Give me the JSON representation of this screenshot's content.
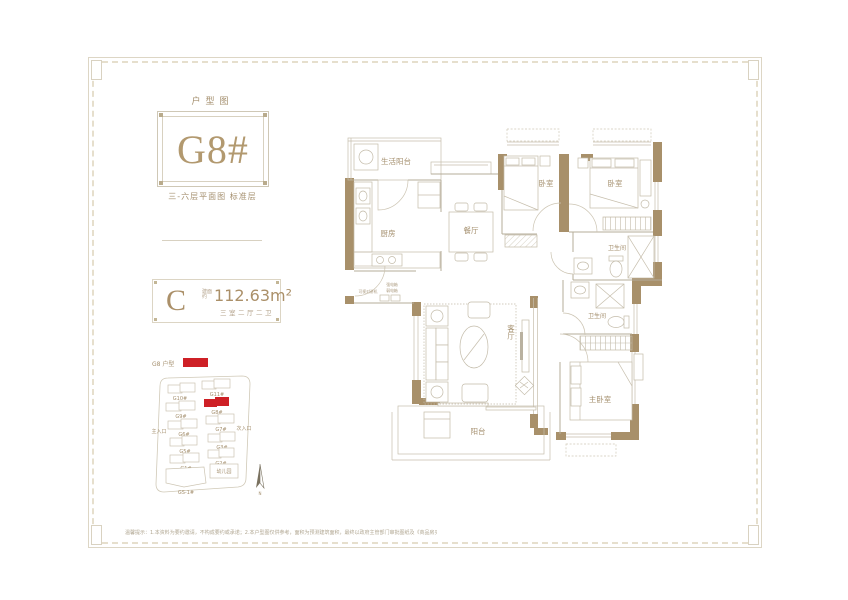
{
  "colors": {
    "accent_bronze": "#ab9069",
    "wall_tan": "#a8906a",
    "highlight_red": "#ce2026",
    "line_light": "#c6beac",
    "background": "#ffffff"
  },
  "header": {
    "title": "户型图",
    "unit_code": "G8#",
    "floor_note": "三-六层平面图 标准层"
  },
  "badge": {
    "type_letter": "C",
    "area_prefix": "建面约",
    "area_value": "112.63m²",
    "rooms_desc": "三室二厅二卫"
  },
  "site_plan": {
    "legend_label": "G8 户型",
    "main_entrance": "主入口",
    "secondary_entrance": "次入口",
    "kindergarten": "幼儿园",
    "compass_label": "N",
    "buildings": [
      "G10#",
      "G11#",
      "G9#",
      "G8#",
      "G6#",
      "G7#",
      "G5#",
      "G3#",
      "G1#",
      "G2#",
      "GS-1#"
    ]
  },
  "floor_plan": {
    "rooms": {
      "service_balcony": "生活阳台",
      "kitchen": "厨房",
      "dining": "餐厅",
      "bedroom_a": "卧室",
      "bedroom_b": "卧室",
      "bath_a": "卫生间",
      "bath_b": "卫生间",
      "living": "客厅",
      "balcony": "阳台",
      "master_bedroom": "主卧室"
    },
    "annotations": {
      "intercom": "可视对讲机",
      "strong_box": "强电箱",
      "weak_box": "弱电箱"
    }
  },
  "footer": {
    "disclaimer": "温馨提示：1.本资料为要约邀请，不构成要约或承诺；2.本户型图仅供参考，面积为预测建筑面积，最终以政府主管部门审批图纸及《商品房买卖合同》约定为准；3.装修、家具、家电等非交付标准，图示仅为示意；4.开发商保留对本资料修改的权利，敬请留意最新信息。"
  }
}
